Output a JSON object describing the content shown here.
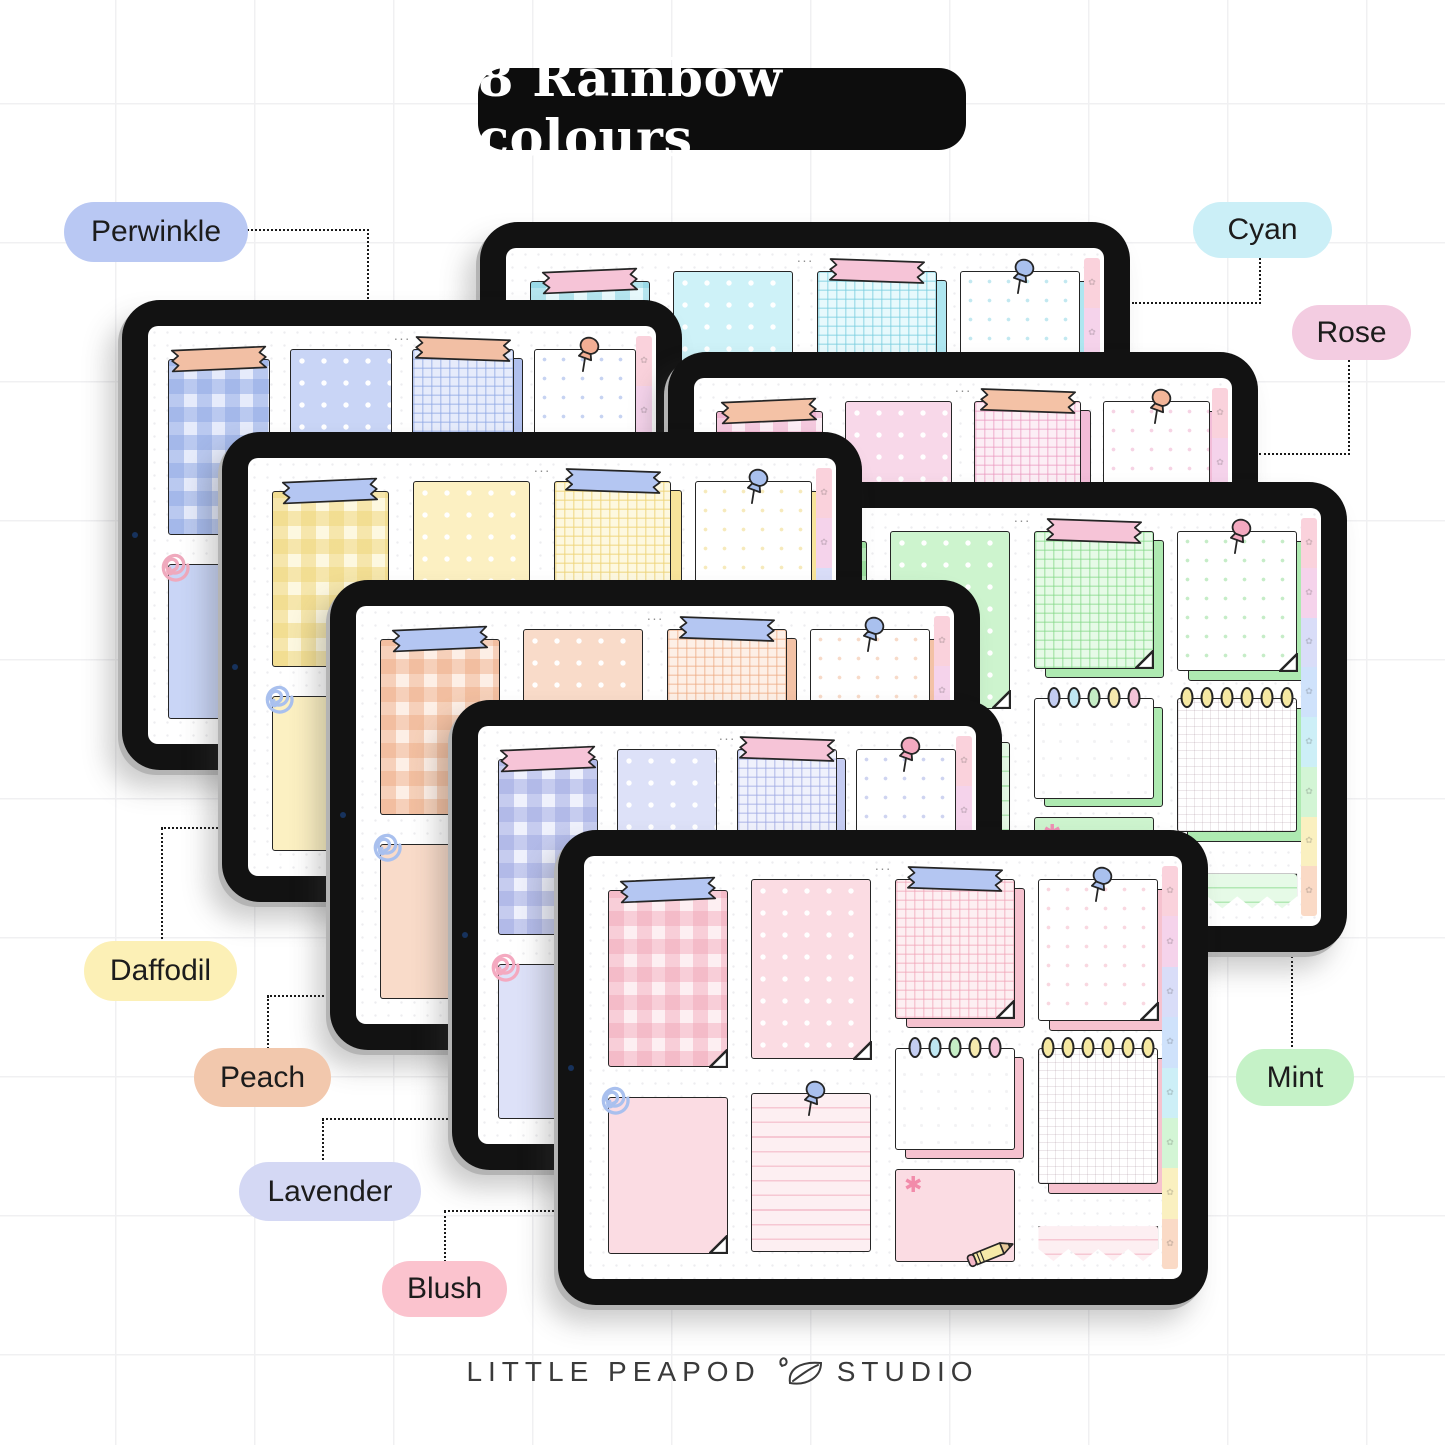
{
  "title": {
    "text": "8 Rainbow colours"
  },
  "labels": [
    {
      "name": "perwinkle",
      "text": "Perwinkle",
      "color": "#b9c8f3"
    },
    {
      "name": "cyan",
      "text": "Cyan",
      "color": "#cbeff7"
    },
    {
      "name": "rose",
      "text": "Rose",
      "color": "#f3cce1"
    },
    {
      "name": "daffodil",
      "text": "Daffodil",
      "color": "#fcf0b6"
    },
    {
      "name": "peach",
      "text": "Peach",
      "color": "#f2c8ad"
    },
    {
      "name": "lavender",
      "text": "Lavender",
      "color": "#d4d8f4"
    },
    {
      "name": "blush",
      "text": "Blush",
      "color": "#fbc3ce"
    },
    {
      "name": "mint",
      "text": "Mint",
      "color": "#c5f2c7"
    }
  ],
  "tablets": [
    {
      "name": "cyan",
      "x": 480,
      "y": 222,
      "w": 650,
      "h": 470,
      "z": 1,
      "colors": {
        "base": "#b9ebf3",
        "light": "#cef2f8",
        "lighter": "#e7f9fc",
        "backing": "#aee6f0",
        "stripe": "rgba(120,205,222,0.45)",
        "gridline": "rgba(120,205,222,0.55)",
        "washi": "#f6c4d7",
        "pin": "#a9c0ee",
        "clip": "#a9c0ee",
        "flower": "#f2a9c4"
      }
    },
    {
      "name": "periwinkle",
      "x": 122,
      "y": 300,
      "w": 560,
      "h": 470,
      "z": 2,
      "colors": {
        "base": "#b7c6f1",
        "light": "#c9d5f6",
        "lighter": "#e6ebfb",
        "backing": "#b0c0ee",
        "stripe": "rgba(142,167,228,0.5)",
        "gridline": "rgba(142,167,228,0.55)",
        "washi": "#f2bfa4",
        "pin": "#f2ae94",
        "clip": "#efa9bd",
        "flower": "#f2a9c4"
      }
    },
    {
      "name": "rose",
      "x": 668,
      "y": 352,
      "w": 590,
      "h": 470,
      "z": 3,
      "colors": {
        "base": "#f4c6de",
        "light": "#f8d8e9",
        "lighter": "#fceef5",
        "backing": "#f2bcd8",
        "stripe": "rgba(233,150,190,0.42)",
        "gridline": "rgba(233,150,190,0.5)",
        "washi": "#f4c2a6",
        "pin": "#f2b598",
        "clip": "#f2b598",
        "flower": "#ee8fb4"
      }
    },
    {
      "name": "mint",
      "x": 697,
      "y": 482,
      "w": 650,
      "h": 470,
      "z": 4,
      "colors": {
        "base": "#b7edb9",
        "light": "#cdf4ce",
        "lighter": "#e6fae7",
        "backing": "#aeeab1",
        "stripe": "rgba(126,214,130,0.45)",
        "gridline": "rgba(126,214,130,0.5)",
        "washi": "#f6c4d7",
        "pin": "#f4a9c0",
        "clip": "#f4a9c0",
        "flower": "#ee8fb4"
      }
    },
    {
      "name": "daffodil",
      "x": 222,
      "y": 432,
      "w": 640,
      "h": 470,
      "z": 5,
      "colors": {
        "base": "#fae8a6",
        "light": "#fcf0c2",
        "lighter": "#fdf8e0",
        "backing": "#f8e49a",
        "stripe": "rgba(238,212,120,0.5)",
        "gridline": "rgba(238,212,120,0.62)",
        "washi": "#b4c6f2",
        "pin": "#a9c0ee",
        "clip": "#a9c0ee",
        "flower": "#f2a9c4"
      }
    },
    {
      "name": "peach",
      "x": 330,
      "y": 580,
      "w": 650,
      "h": 470,
      "z": 6,
      "colors": {
        "base": "#f5cbb2",
        "light": "#f9dbc9",
        "lighter": "#fdefe6",
        "backing": "#f3c2a6",
        "stripe": "rgba(236,166,124,0.42)",
        "gridline": "rgba(236,166,124,0.5)",
        "washi": "#b4c6f2",
        "pin": "#a9c0ee",
        "clip": "#a9c0ee",
        "flower": "#f2a9c4"
      }
    },
    {
      "name": "lavender",
      "x": 452,
      "y": 700,
      "w": 550,
      "h": 470,
      "z": 7,
      "colors": {
        "base": "#cdd3f4",
        "light": "#dde1f8",
        "lighter": "#eff1fc",
        "backing": "#c5ccf2",
        "stripe": "rgba(158,168,226,0.5)",
        "gridline": "rgba(158,168,226,0.55)",
        "washi": "#f6c4d7",
        "pin": "#f4a9c0",
        "clip": "#f4a9c0",
        "flower": "#ee8fb4"
      }
    },
    {
      "name": "blush",
      "x": 558,
      "y": 830,
      "w": 650,
      "h": 475,
      "z": 8,
      "colors": {
        "base": "#f8ccd6",
        "light": "#fbdce3",
        "lighter": "#fdeff2",
        "backing": "#f6c2cf",
        "stripe": "rgba(240,160,180,0.42)",
        "gridline": "rgba(240,160,180,0.5)",
        "washi": "#b4c6f2",
        "pin": "#a9c0ee",
        "clip": "#a9c0ee",
        "flower": "#f28baa"
      }
    }
  ],
  "ui": {
    "menu_dots": "···",
    "flower_char": "✱",
    "tab_flower": "✿",
    "ring_colors": [
      "#c3cdf2",
      "#bfe7f2",
      "#c6eec6",
      "#f5e9ae",
      "#f4c3d8"
    ],
    "coil_color": "#f6e9a2",
    "coil_count": 6,
    "tab_colors": [
      "#fad2dc",
      "#f5d3eb",
      "#d9ddf8",
      "#cfe2fb",
      "#cdeff7",
      "#d3f5d5",
      "#faf0c0",
      "#fadac6"
    ]
  },
  "footer": {
    "brand_left": "LITTLE PEAPOD",
    "brand_right": "STUDIO"
  }
}
